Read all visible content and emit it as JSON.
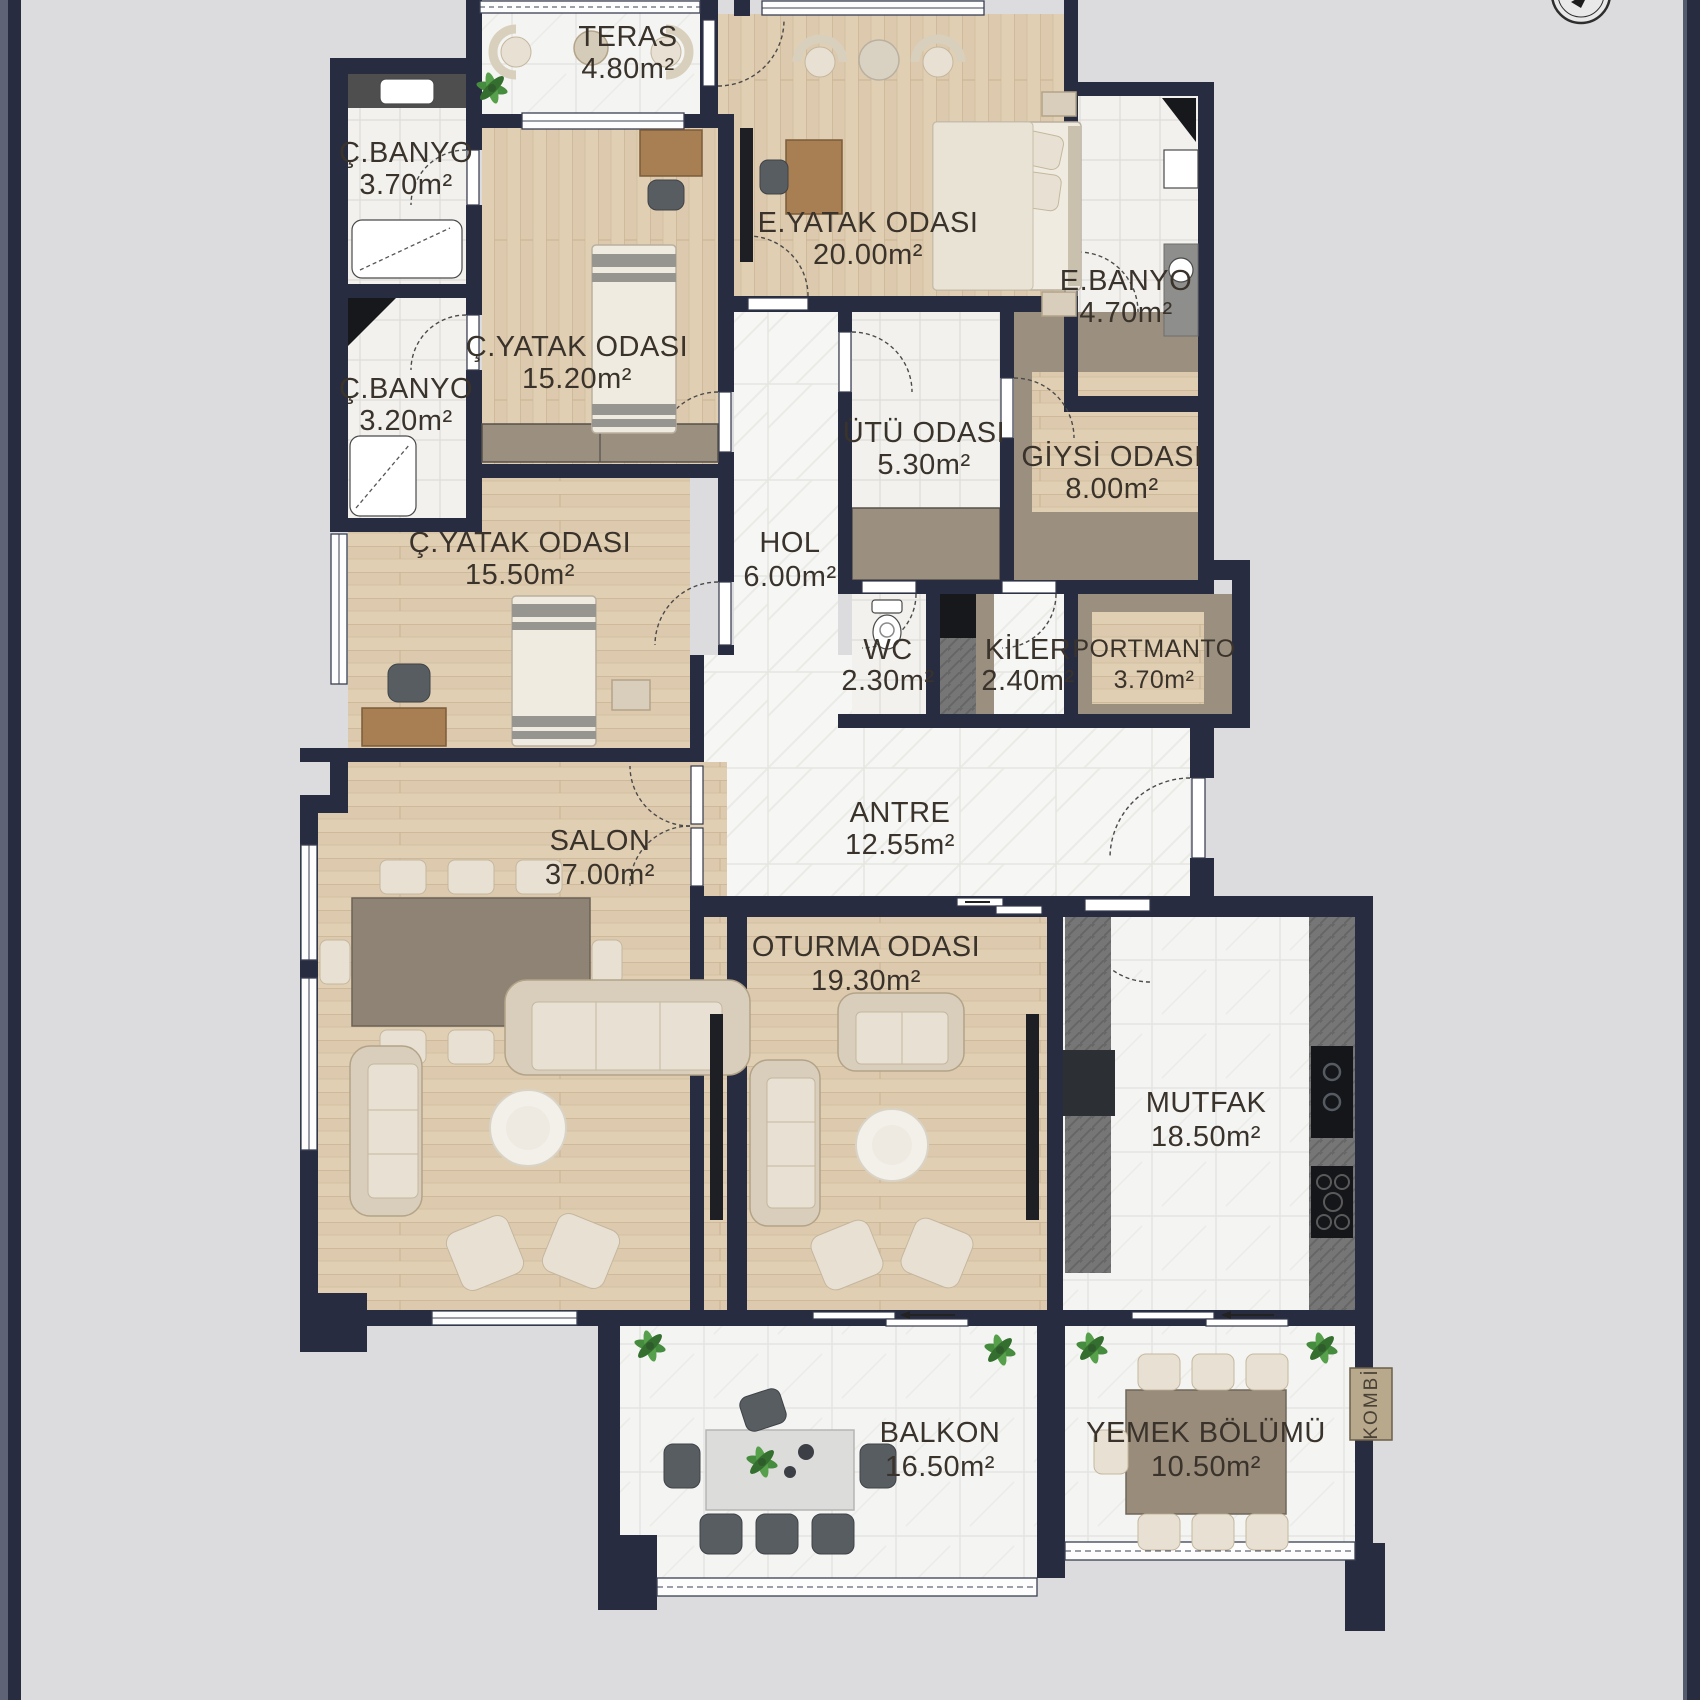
{
  "plan": {
    "title": "apartment-floor-plan",
    "colors": {
      "background": "#dcdcde",
      "wall": "#272c40",
      "wood_floor": "#ddc9ad",
      "marble_floor": "#f5f5f3",
      "cabinet_taupe": "#9b8f7f",
      "label_text": "#3a332b"
    },
    "rooms": [
      {
        "id": "teras",
        "name": "TERAS",
        "area": "4.80m²"
      },
      {
        "id": "cbanyo1",
        "name": "Ç.BANYO",
        "area": "3.70m²"
      },
      {
        "id": "cbanyo2",
        "name": "Ç.BANYO",
        "area": "3.20m²"
      },
      {
        "id": "cyatak1",
        "name": "Ç.YATAK ODASI",
        "area": "15.20m²"
      },
      {
        "id": "eyatak",
        "name": "E.YATAK ODASI",
        "area": "20.00m²"
      },
      {
        "id": "ebanyo",
        "name": "E.BANYO",
        "area": "4.70m²"
      },
      {
        "id": "utu",
        "name": "ÜTÜ ODASI",
        "area": "5.30m²"
      },
      {
        "id": "giysi",
        "name": "GİYSİ ODASI",
        "area": "8.00m²"
      },
      {
        "id": "cyatak2",
        "name": "Ç.YATAK ODASI",
        "area": "15.50m²"
      },
      {
        "id": "hol",
        "name": "HOL",
        "area": "6.00m²"
      },
      {
        "id": "wc",
        "name": "WC",
        "area": "2.30m²"
      },
      {
        "id": "kiler",
        "name": "KİLER",
        "area": "2.40m²"
      },
      {
        "id": "portmanto",
        "name": "PORTMANTO",
        "area": "3.70m²"
      },
      {
        "id": "antre",
        "name": "ANTRE",
        "area": "12.55m²"
      },
      {
        "id": "salon",
        "name": "SALON",
        "area": "37.00m²"
      },
      {
        "id": "oturma",
        "name": "OTURMA ODASI",
        "area": "19.30m²"
      },
      {
        "id": "mutfak",
        "name": "MUTFAK",
        "area": "18.50m²"
      },
      {
        "id": "balkon",
        "name": "BALKON",
        "area": "16.50m²"
      },
      {
        "id": "yemek",
        "name": "YEMEK BÖLÜMÜ",
        "area": "10.50m²"
      }
    ],
    "equipment": {
      "kombi": "KOMBİ"
    }
  }
}
